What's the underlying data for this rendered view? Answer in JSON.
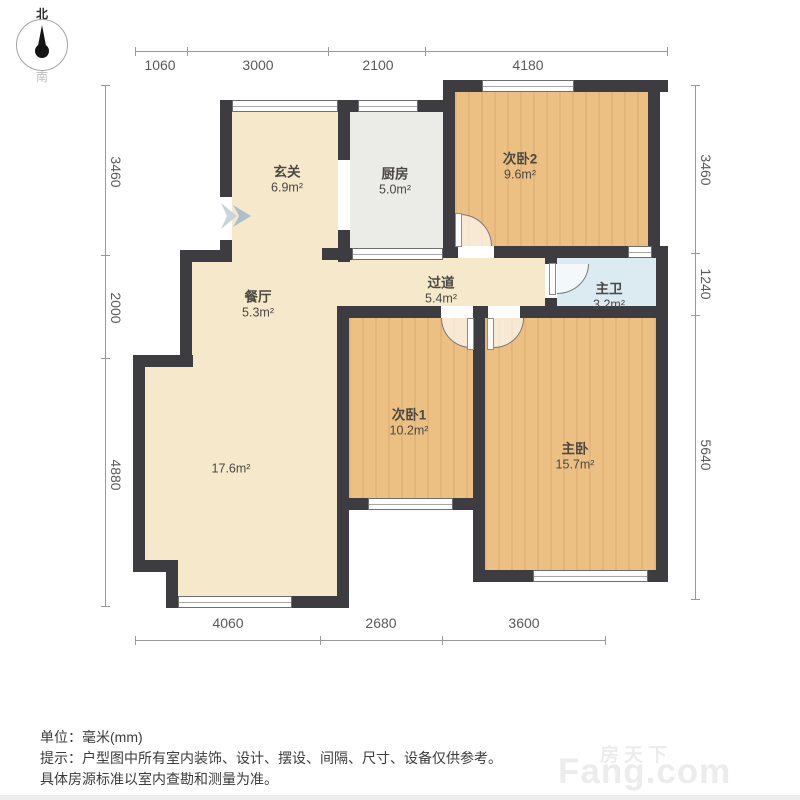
{
  "compass": {
    "north": "北",
    "south": "南"
  },
  "rooms": {
    "xuanguan": {
      "name": "玄关",
      "area": "6.9m²"
    },
    "chufang": {
      "name": "厨房",
      "area": "5.0m²"
    },
    "ciwo2": {
      "name": "次卧2",
      "area": "9.6m²"
    },
    "canting": {
      "name": "餐厅",
      "area": "5.3m²"
    },
    "guodao": {
      "name": "过道",
      "area": "5.4m²"
    },
    "zhuwei": {
      "name": "主卫",
      "area": "3.2m²"
    },
    "ciwo1": {
      "name": "次卧1",
      "area": "10.2m²"
    },
    "zhuwo": {
      "name": "主卧",
      "area": "15.7m²"
    },
    "keting": {
      "area": "17.6m²"
    }
  },
  "dimensions": {
    "top": [
      "1060",
      "3000",
      "2100",
      "4180"
    ],
    "left": [
      "3460",
      "2000",
      "4880"
    ],
    "right": [
      "3460",
      "1240",
      "5640"
    ],
    "bottom": [
      "4060",
      "2680",
      "3600"
    ]
  },
  "notes": {
    "unit": "单位：毫米(mm)",
    "tip1": "提示：户型图中所有室内装饰、设计、摆设、间隔、尺寸、设备仅供参考。",
    "tip2": "具体房源标准以室内查勘和测量为准。"
  },
  "watermark": {
    "cn": "房天下",
    "en": "Fang.com"
  },
  "colors": {
    "wall": "#3d3d41",
    "wood": "#ecbf83",
    "beige": "#f6e9cb",
    "bath": "#dcebf2",
    "kitchen": "#ebebe7"
  }
}
